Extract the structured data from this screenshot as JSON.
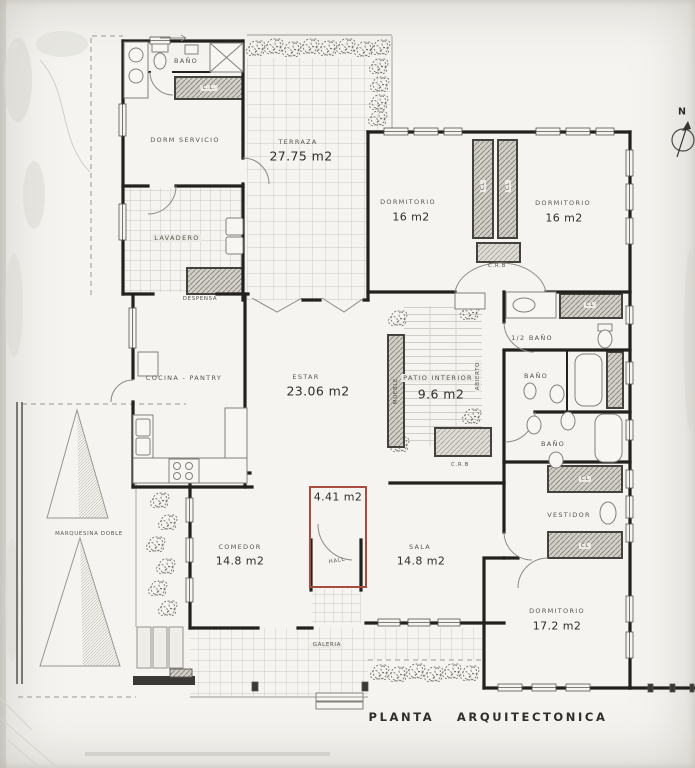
{
  "title": "PLANTA ARQUITECTONICA",
  "north_indicator": "N",
  "colors": {
    "highlight_red": "#a84c40",
    "paper": "#f5f4f0",
    "wall_ink": "#23211d"
  },
  "rooms": {
    "bano_servicio": {
      "label": "BAÑO"
    },
    "closet_servicio": {
      "label": "C.L."
    },
    "dorm_servicio": {
      "label": "DORM SERVICIO"
    },
    "terraza": {
      "label": "TERRAZA",
      "area": "27.75 m2"
    },
    "dormitorio_1": {
      "label": "DORMITORIO",
      "area": "16 m2"
    },
    "dormitorio_2": {
      "label": "DORMITORIO",
      "area": "16 m2"
    },
    "closet_1": {
      "label": "CL"
    },
    "closet_2": {
      "label": "CL"
    },
    "crb_1": {
      "label": "C.R.B"
    },
    "lavadero": {
      "label": "LAVADERO"
    },
    "despensa": {
      "label": "DESPENSA"
    },
    "cocina": {
      "label": "COCINA - PANTRY"
    },
    "estar": {
      "label": "ESTAR",
      "area": "23.06 m2"
    },
    "patio_interior": {
      "label": "PATIO INTERIOR",
      "area": "9.6 m2"
    },
    "mueble": {
      "label": "MUEBLE"
    },
    "abierto": {
      "label": "ABIERTO"
    },
    "crb_2": {
      "label": "C.R.B"
    },
    "medio_bano": {
      "label": "1/2 BAÑO"
    },
    "closet_3": {
      "label": "CL"
    },
    "bano_1": {
      "label": "BAÑO"
    },
    "bano_2": {
      "label": "BAÑO"
    },
    "closet_4": {
      "label": "CL"
    },
    "vestidor": {
      "label": "VESTIDOR"
    },
    "closet_5": {
      "label": "CL"
    },
    "dormitorio_3": {
      "label": "DORMITORIO",
      "area": "17.2 m2"
    },
    "marquesina": {
      "label": "MARQUESINA DOBLE"
    },
    "comedor": {
      "label": "COMEDOR",
      "area": "14.8 m2"
    },
    "hall": {
      "label": "HALL",
      "area": "4.41 m2"
    },
    "sala": {
      "label": "SALA",
      "area": "14.8 m2"
    },
    "galeria": {
      "label": "GALERIA"
    }
  }
}
